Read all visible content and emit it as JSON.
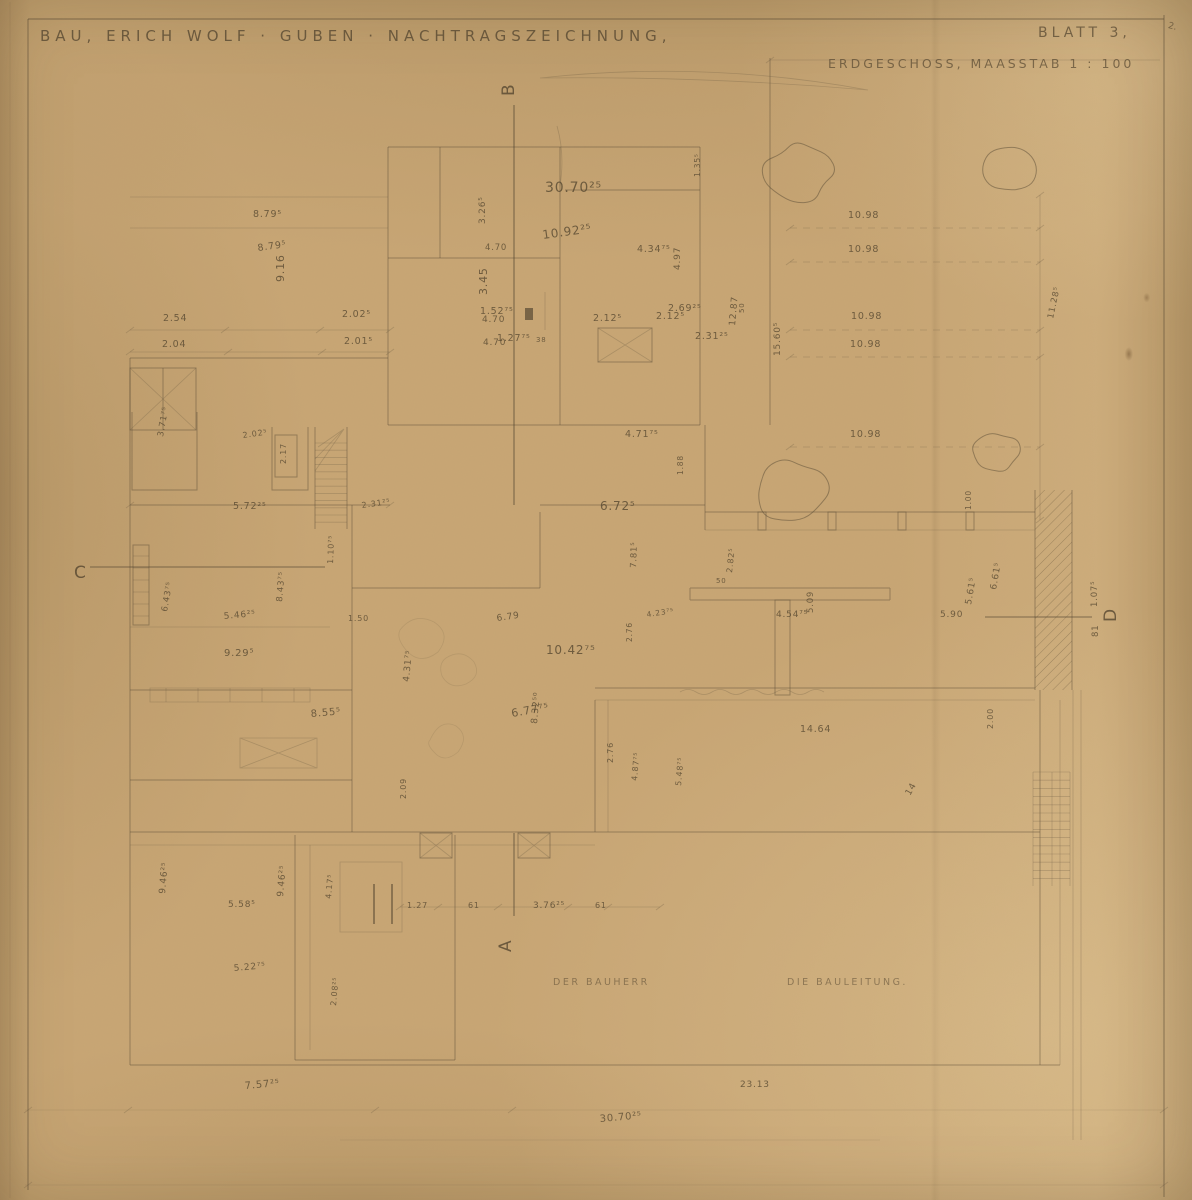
{
  "title_block": {
    "project_title": "BAU, ERICH WOLF · GUBEN · NACHTRAGSZEICHNUNG,",
    "sheet_label": "BLATT 3,",
    "drawing_label": "ERDGESCHOSS, MAASSTAB 1 : 100",
    "corner_mark": "2."
  },
  "signature_line": {
    "owner": "DER BAUHERR",
    "site_management": "DIE BAULEITUNG."
  },
  "colors": {
    "paper": "#c8a674",
    "ink": "#5a4b35",
    "pencil": "#5f5038"
  },
  "section_markers": [
    {
      "label": "B",
      "x": 514,
      "y": 96,
      "r": -90
    },
    {
      "label": "A",
      "x": 511,
      "y": 952,
      "r": -90
    },
    {
      "label": "C",
      "x": 74,
      "y": 578,
      "r": 0
    },
    {
      "label": "D",
      "x": 1116,
      "y": 622,
      "r": -90
    }
  ],
  "dimension_labels": [
    {
      "t": "8.79⁵",
      "x": 253,
      "y": 217
    },
    {
      "t": "8.79⁵",
      "x": 258,
      "y": 251,
      "r": -8
    },
    {
      "t": "9.16",
      "x": 284,
      "y": 282,
      "r": -90,
      "s": 11
    },
    {
      "t": "2.54",
      "x": 163,
      "y": 321
    },
    {
      "t": "2.02⁵",
      "x": 342,
      "y": 317
    },
    {
      "t": "1.52⁷⁵",
      "x": 480,
      "y": 314
    },
    {
      "t": "2.69²⁵",
      "x": 668,
      "y": 311
    },
    {
      "t": "2.04",
      "x": 162,
      "y": 347
    },
    {
      "t": "2.01⁵",
      "x": 344,
      "y": 344
    },
    {
      "t": "1.27⁷⁵",
      "x": 497,
      "y": 341
    },
    {
      "t": "38",
      "x": 536,
      "y": 342,
      "s": 7
    },
    {
      "t": "2.31²⁵",
      "x": 695,
      "y": 339
    },
    {
      "t": "30.70²⁵",
      "x": 545,
      "y": 192,
      "s": 14
    },
    {
      "t": "10.92²⁵",
      "x": 543,
      "y": 239,
      "r": -8,
      "s": 12
    },
    {
      "t": "3.26⁵",
      "x": 485,
      "y": 224,
      "r": -90,
      "s": 9
    },
    {
      "t": "4.70",
      "x": 485,
      "y": 250,
      "s": 8.5
    },
    {
      "t": "3.45",
      "x": 487,
      "y": 295,
      "r": -90,
      "s": 11
    },
    {
      "t": "4.70",
      "x": 482,
      "y": 322,
      "s": 9
    },
    {
      "t": "4.70",
      "x": 483,
      "y": 345,
      "s": 9
    },
    {
      "t": "4.34⁷⁵",
      "x": 637,
      "y": 252
    },
    {
      "t": "4.97",
      "x": 680,
      "y": 270,
      "r": -90,
      "s": 9
    },
    {
      "t": "1.35⁵",
      "x": 700,
      "y": 177,
      "r": -90,
      "s": 7.5
    },
    {
      "t": "2.12⁵",
      "x": 593,
      "y": 321
    },
    {
      "t": "2.12⁵",
      "x": 656,
      "y": 319
    },
    {
      "t": "12.87",
      "x": 735,
      "y": 326,
      "r": -85,
      "s": 9
    },
    {
      "t": "15.60⁵",
      "x": 780,
      "y": 356,
      "r": -90,
      "s": 9
    },
    {
      "t": "10.98",
      "x": 848,
      "y": 218
    },
    {
      "t": "10.98",
      "x": 848,
      "y": 252
    },
    {
      "t": "10.98",
      "x": 851,
      "y": 319
    },
    {
      "t": "10.98",
      "x": 850,
      "y": 347
    },
    {
      "t": "10.98",
      "x": 850,
      "y": 437
    },
    {
      "t": "11.28⁵",
      "x": 1053,
      "y": 319,
      "r": -78,
      "s": 8.5
    },
    {
      "t": "50",
      "x": 744,
      "y": 313,
      "r": -90,
      "s": 7
    },
    {
      "t": "50",
      "x": 716,
      "y": 583,
      "s": 7
    },
    {
      "t": "4.71⁷⁵",
      "x": 625,
      "y": 437
    },
    {
      "t": "6.72⁵",
      "x": 600,
      "y": 510,
      "s": 12
    },
    {
      "t": "1.88",
      "x": 683,
      "y": 475,
      "r": -90,
      "s": 7.5
    },
    {
      "t": "7.81⁵",
      "x": 636,
      "y": 568,
      "r": -88,
      "s": 8.5
    },
    {
      "t": "2.82⁵",
      "x": 732,
      "y": 573,
      "r": -84,
      "s": 8
    },
    {
      "t": "4.54⁷⁵",
      "x": 776,
      "y": 617,
      "s": 9
    },
    {
      "t": "5.09",
      "x": 813,
      "y": 613,
      "r": -90,
      "s": 8.5
    },
    {
      "t": "4.23⁷⁵",
      "x": 647,
      "y": 617,
      "r": -8,
      "s": 7.5
    },
    {
      "t": "3.71⁷⁵",
      "x": 163,
      "y": 437,
      "r": -80,
      "s": 8.5
    },
    {
      "t": "2.02⁵",
      "x": 243,
      "y": 438,
      "r": -8,
      "s": 8
    },
    {
      "t": "2.17",
      "x": 286,
      "y": 464,
      "r": -90,
      "s": 8
    },
    {
      "t": "5.72²⁵",
      "x": 233,
      "y": 509
    },
    {
      "t": "2.31²⁵",
      "x": 362,
      "y": 508,
      "r": -8,
      "s": 8
    },
    {
      "t": "1.10⁷⁵",
      "x": 333,
      "y": 564,
      "r": -88,
      "s": 8
    },
    {
      "t": "6.43⁷⁵",
      "x": 167,
      "y": 612,
      "r": -80,
      "s": 8.5
    },
    {
      "t": "8.43⁷⁵",
      "x": 282,
      "y": 602,
      "r": -85,
      "s": 8.5
    },
    {
      "t": "5.46²⁵",
      "x": 224,
      "y": 619,
      "r": -5,
      "s": 9
    },
    {
      "t": "9.29⁵",
      "x": 224,
      "y": 656,
      "s": 10
    },
    {
      "t": "8.55⁵",
      "x": 311,
      "y": 717,
      "r": -5,
      "s": 10
    },
    {
      "t": "1.50",
      "x": 348,
      "y": 621,
      "s": 8
    },
    {
      "t": "10.42⁷⁵",
      "x": 546,
      "y": 654,
      "s": 12
    },
    {
      "t": "6.77⁷⁵",
      "x": 512,
      "y": 717,
      "r": -10,
      "s": 11
    },
    {
      "t": "8.32⁵⁰",
      "x": 537,
      "y": 724,
      "r": -85,
      "s": 9
    },
    {
      "t": "6.79",
      "x": 497,
      "y": 621,
      "r": -8,
      "s": 9
    },
    {
      "t": "4.31⁷⁵",
      "x": 409,
      "y": 682,
      "r": -85,
      "s": 9
    },
    {
      "t": "2.09",
      "x": 406,
      "y": 799,
      "r": -90,
      "s": 8
    },
    {
      "t": "2.76",
      "x": 613,
      "y": 763,
      "r": -90,
      "s": 8
    },
    {
      "t": "4.87⁷⁵",
      "x": 637,
      "y": 781,
      "r": -85,
      "s": 8
    },
    {
      "t": "2.76",
      "x": 632,
      "y": 642,
      "r": -90,
      "s": 7.5
    },
    {
      "t": "5.90",
      "x": 940,
      "y": 617,
      "s": 9
    },
    {
      "t": "5.61⁵",
      "x": 971,
      "y": 605,
      "r": -80,
      "s": 9
    },
    {
      "t": "6.61⁵",
      "x": 996,
      "y": 590,
      "r": -80,
      "s": 9
    },
    {
      "t": "1.07⁵",
      "x": 1097,
      "y": 607,
      "r": -90,
      "s": 8.5
    },
    {
      "t": "81",
      "x": 1098,
      "y": 637,
      "r": -90,
      "s": 8.5
    },
    {
      "t": "1.00",
      "x": 971,
      "y": 510,
      "r": -90,
      "s": 7.5
    },
    {
      "t": "2.00",
      "x": 993,
      "y": 729,
      "r": -90,
      "s": 8
    },
    {
      "t": "14.64",
      "x": 800,
      "y": 732,
      "s": 9.5
    },
    {
      "t": "5.48⁷⁵",
      "x": 681,
      "y": 786,
      "r": -85,
      "s": 8
    },
    {
      "t": "14",
      "x": 910,
      "y": 796,
      "r": -60,
      "s": 9
    },
    {
      "t": "9.46²⁵",
      "x": 165,
      "y": 894,
      "r": -85,
      "s": 9
    },
    {
      "t": "5.58⁵",
      "x": 228,
      "y": 907,
      "s": 9
    },
    {
      "t": "9.46²⁵",
      "x": 283,
      "y": 897,
      "r": -85,
      "s": 9
    },
    {
      "t": "4.17⁵",
      "x": 331,
      "y": 899,
      "r": -85,
      "s": 8
    },
    {
      "t": "2.08²⁵",
      "x": 336,
      "y": 1006,
      "r": -85,
      "s": 8
    },
    {
      "t": "5.22⁷⁵",
      "x": 234,
      "y": 971,
      "r": -5,
      "s": 9
    },
    {
      "t": "1.27",
      "x": 407,
      "y": 908,
      "s": 8
    },
    {
      "t": "61",
      "x": 468,
      "y": 908,
      "s": 8
    },
    {
      "t": "3.76²⁵",
      "x": 533,
      "y": 908,
      "s": 9
    },
    {
      "t": "61",
      "x": 595,
      "y": 908,
      "s": 8
    },
    {
      "t": "7.57²⁵",
      "x": 245,
      "y": 1089,
      "r": -5,
      "s": 10
    },
    {
      "t": "23.13",
      "x": 740,
      "y": 1087,
      "s": 9
    },
    {
      "t": "30.70²⁵",
      "x": 600,
      "y": 1122,
      "r": -5,
      "s": 10
    }
  ],
  "trees": [
    {
      "cx": 800,
      "cy": 172,
      "r": 38,
      "seed": 7
    },
    {
      "cx": 1008,
      "cy": 170,
      "r": 29,
      "seed": 13
    },
    {
      "cx": 790,
      "cy": 490,
      "r": 42,
      "seed": 21
    },
    {
      "cx": 995,
      "cy": 452,
      "r": 26,
      "seed": 31
    }
  ]
}
